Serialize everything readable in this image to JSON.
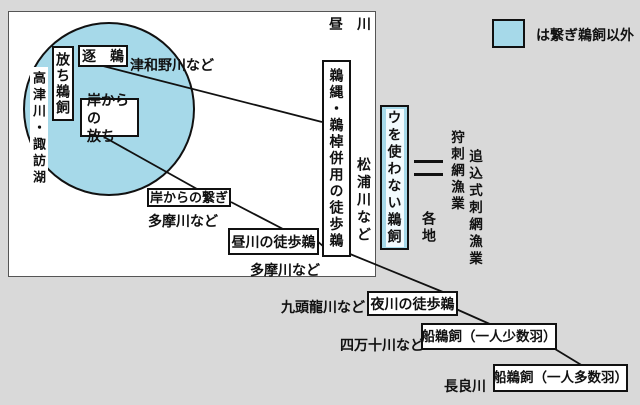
{
  "colors": {
    "background": "#d9d9d9",
    "panel": "#ffffff",
    "blue": "#a6d9e9",
    "line": "#111111"
  },
  "legend": {
    "label": "は繋ぎ鵜飼以外"
  },
  "panel": {
    "corner_label": "昼　川"
  },
  "circle_region": {
    "water_label": "高津川・諏訪湖",
    "hanachi_ukai": "放ち鵜飼",
    "oi_u": "逐　鵜",
    "oi_u_river": "津和野川など",
    "kishi_hanachi": "岸からの\n放ち"
  },
  "nodes": {
    "kishi_tsunagi": "岸からの繋ぎ",
    "hiru_kachiu": "昼川の徒歩鵜",
    "unawa_usao": "鵜縄・鵜棹併用の徒歩鵜",
    "u_tsukawanai": "ウを使わない鵜飼",
    "yokawa_kachiu": "夜川の徒歩鵜",
    "funaukai_shosu": "船鵜飼（一人少数羽）",
    "funaukai_tasu": "船鵜飼（一人多数羽）"
  },
  "annotations": {
    "tamagawa_1": "多摩川など",
    "tamagawa_2": "多摩川など",
    "matsuura": "松浦川など",
    "kuzuryu": "九頭龍川など",
    "shimanto": "四万十川など",
    "nagara": "長良川",
    "kakuchi": "各地",
    "kari_sashiami": "狩刺網漁業",
    "oikomi_sashiami": "追込式刺網漁業"
  }
}
